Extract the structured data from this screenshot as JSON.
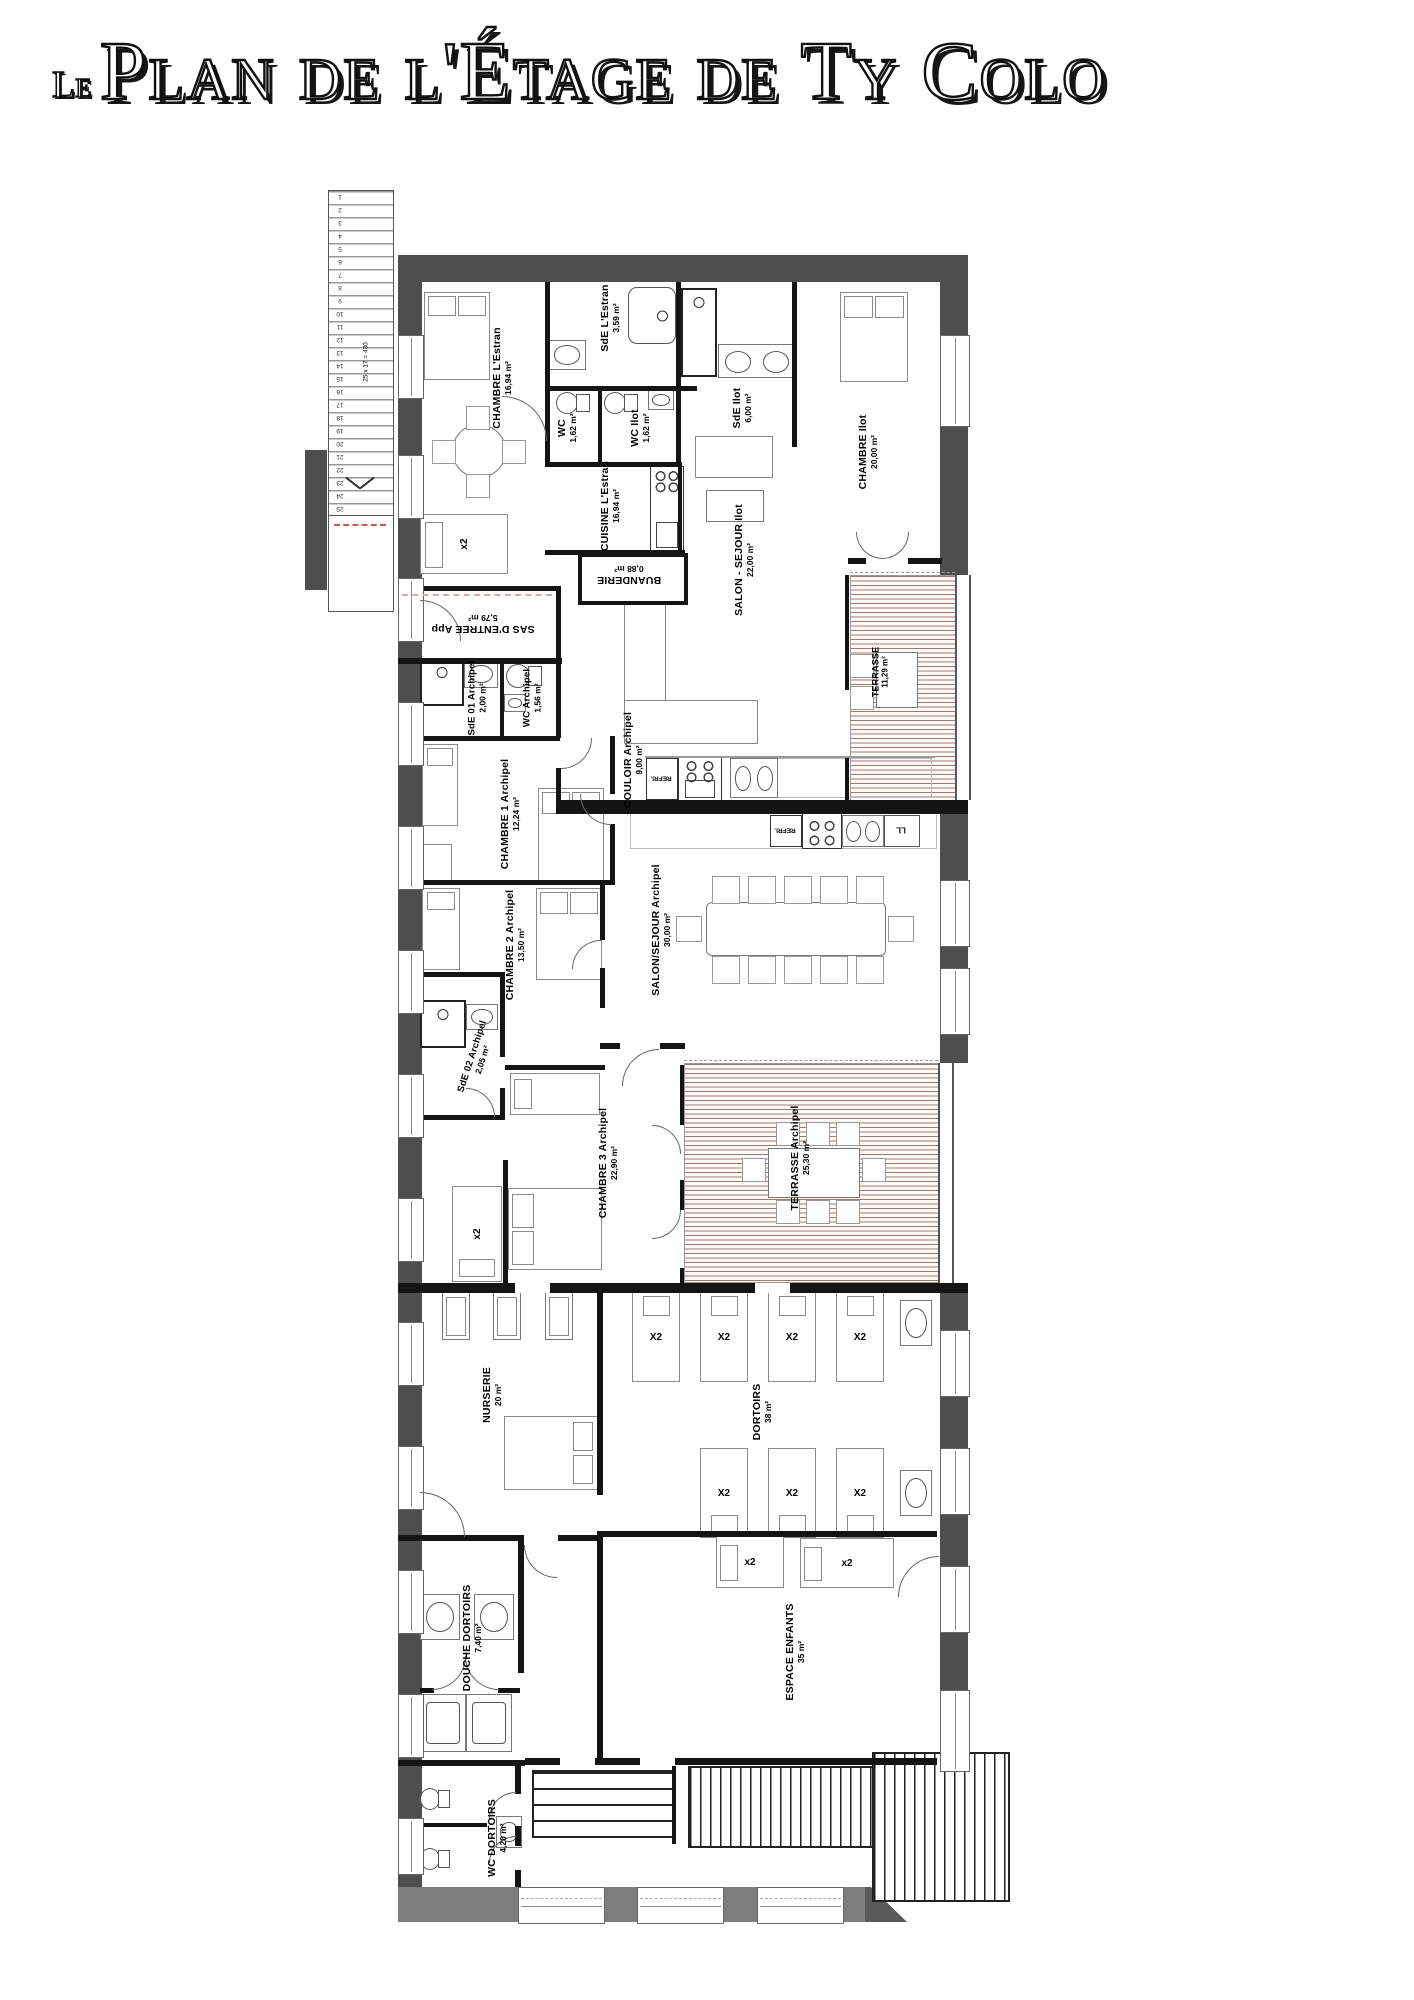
{
  "title": {
    "prefix": "Le",
    "text": "Plan de l'Étage de Ty Colo"
  },
  "stairs": {
    "count": 25,
    "annotation": "25 x 17 = 430"
  },
  "labels": {
    "refri": "REFRI.",
    "washer": "LL",
    "x2_lower": "x2",
    "x2_upper": "X2"
  },
  "colors": {
    "exterior_wall": "#4e4e4e",
    "interior_wall": "#141414",
    "terrace_stripe": "#9c7268"
  },
  "rooms": {
    "chambre_estran": {
      "name": "CHAMBRE L'Estran",
      "area": "16,94 m²"
    },
    "sde_estran": {
      "name": "SdE L'Estran",
      "area": "3,59 m²"
    },
    "wc": {
      "name": "WC",
      "area": "1,62 m²"
    },
    "wc_ilot": {
      "name": "WC Ilot",
      "area": "1,62 m²"
    },
    "sde_ilot": {
      "name": "SdE Ilot",
      "area": "6,00 m²"
    },
    "chambre_ilot": {
      "name": "CHAMBRE Ilot",
      "area": "20,00 m²"
    },
    "cuisine_estran": {
      "name": "CUISINE L'Estran",
      "area": "16,94 m²"
    },
    "buanderie": {
      "name": "BUANDERIE",
      "area": "0,88 m²"
    },
    "sas_entree": {
      "name": "SAS D'ENTREE App",
      "area": "5,79 m²"
    },
    "salon_ilot": {
      "name": "SALON - SEJOUR Ilot",
      "area": "22,00 m²"
    },
    "terrasse": {
      "name": "TERRASSE",
      "area": "11,29 m²"
    },
    "sde01": {
      "name": "SdE 01 Archipel",
      "area": "2,00 m²"
    },
    "wc_archipel": {
      "name": "WC Archipel",
      "area": "1,56 m²"
    },
    "couloir": {
      "name": "COULOIR Archipel",
      "area": "9,00 m²"
    },
    "chambre1": {
      "name": "CHAMBRE 1 Archipel",
      "area": "12,24 m²"
    },
    "chambre2": {
      "name": "CHAMBRE 2 Archipel",
      "area": "13,50 m²"
    },
    "salon_archipel": {
      "name": "SALON/SEJOUR Archipel",
      "area": "30,00 m²"
    },
    "sde02": {
      "name": "SdE 02 Archipel",
      "area": "2,05 m²"
    },
    "chambre3": {
      "name": "CHAMBRE 3 Archipel",
      "area": "22,90 m²"
    },
    "terrasse_archipel": {
      "name": "TERRASSE Archipel",
      "area": "25,30 m²"
    },
    "nurserie": {
      "name": "NURSERIE",
      "area": "20 m²"
    },
    "dortoirs": {
      "name": "DORTOIRS",
      "area": "38 m²"
    },
    "douche_dortoirs": {
      "name": "DOUCHE DORTOIRS",
      "area": "7,40 m²"
    },
    "espace_enfants": {
      "name": "ESPACE ENFANTS",
      "area": "35 m²"
    },
    "wc_dortoirs": {
      "name": "WC DORTOIRS",
      "area": "4,20 m²"
    }
  }
}
